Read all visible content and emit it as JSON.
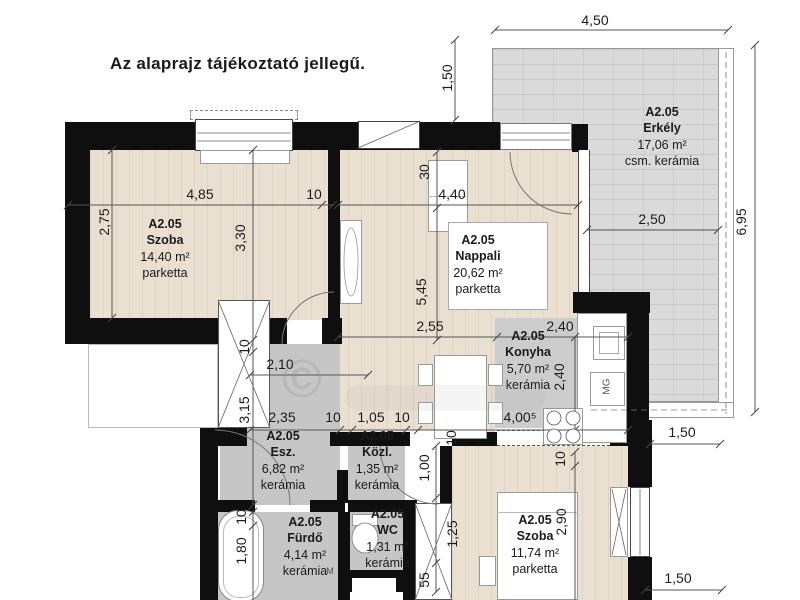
{
  "title": "Az alaprajz tájékoztató jellegű.",
  "watermark": {
    "symbol": "©"
  },
  "rooms": [
    {
      "unit": "A2.05",
      "name": "Szoba",
      "area": "14,40 m²",
      "floor": "parketta"
    },
    {
      "unit": "A2.05",
      "name": "Nappali",
      "area": "20,62 m²",
      "floor": "parketta"
    },
    {
      "unit": "A2.05",
      "name": "Konyha",
      "area": "5,70 m²",
      "floor": "kerámia"
    },
    {
      "unit": "A2.05",
      "name": "Erkély",
      "area": "17,06 m²",
      "floor": "csm. kerámia"
    },
    {
      "unit": "A2.05",
      "name": "Esz.",
      "area": "6,82 m²",
      "floor": "kerámia"
    },
    {
      "unit": "A2.05",
      "name": "Közl.",
      "area": "1,35 m²",
      "floor": "kerámia"
    },
    {
      "unit": "A2.05",
      "name": "WC",
      "area": "1,31 m²",
      "floor": "kerámia"
    },
    {
      "unit": "A2.05",
      "name": "Fürdő",
      "area": "4,14 m²",
      "floor": "kerámia"
    },
    {
      "unit": "A2.05",
      "name": "Szoba",
      "area": "11,74 m²",
      "floor": "parketta"
    }
  ],
  "dims": {
    "balcony_width": "4,50",
    "balcony_offset": "1,50",
    "right_total": "6,95",
    "balcony_inner": "2,50",
    "balcony_below": "1,50",
    "szoba2_right": "1,50",
    "szoba1_w": "4,85",
    "szoba1_w10": "10",
    "szoba1_h1": "2,75",
    "szoba1_h2": "3,30",
    "nappali_off30": "30",
    "nappali_w": "4,40",
    "nappali_h": "5,45",
    "nappali_w2": "2,55",
    "konyha_w": "2,40",
    "konyha_h": "2,40",
    "konyha_total": "4,00⁵",
    "esz_w1": "2,10",
    "esz_w2": "2,35",
    "esz_w10": "10",
    "kozl_w": "1,05",
    "kozl_w10": "10",
    "esz_h10": "10",
    "esz_h": "3,15",
    "hall_h10": "10",
    "hall_1": "1,00",
    "hall_2": "1,25",
    "hall_3": "55",
    "szoba2_off10": "10",
    "szoba2_h": "2,90",
    "furdo_off10": "10",
    "furdo_h": "1,80"
  },
  "appliances": {
    "washing_machine": "MG",
    "basin": "M"
  },
  "colors": {
    "wall": "#0f0f0f",
    "parquet": "#e9e0d1",
    "ceramic": "#c6c6c6",
    "balcony": "#dadada",
    "dimension_line": "#555555"
  }
}
